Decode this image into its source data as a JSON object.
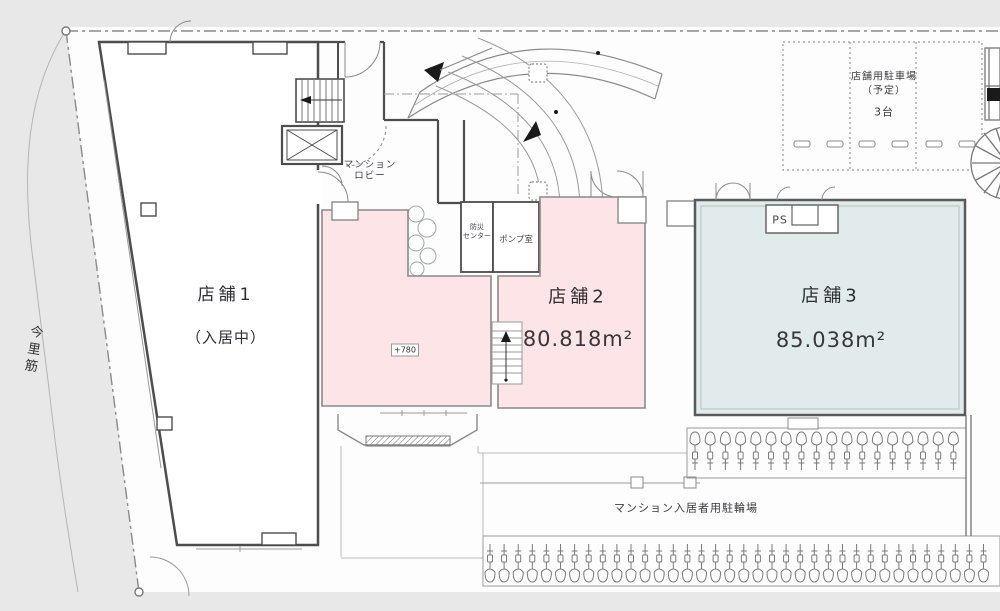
{
  "road": {
    "name": "今里筋"
  },
  "parking": {
    "title": "店舗用駐車場",
    "subtitle": "（予定）",
    "capacity": "3台"
  },
  "lobby": {
    "line1": "マンション",
    "line2": "ロビー"
  },
  "rooms": {
    "disaster_line1": "防災",
    "disaster_line2": "センター",
    "pump": "ポンプ室",
    "pipe_shaft": "PS"
  },
  "shop1": {
    "name": "店舗1",
    "status": "（入居中）"
  },
  "shop2": {
    "name": "店舗2",
    "area": "80.818m²"
  },
  "shop3": {
    "name": "店舗3",
    "area": "85.038m²"
  },
  "annotations": {
    "floor_level": "+780",
    "bicycle_parking": "マンション入居者用駐輪場"
  },
  "colors": {
    "street": "#e8e8e8",
    "wall": "#4d4d4d",
    "shop2_fill": "#fce4e7",
    "shop3_fill": "#e1ebeb"
  },
  "bicycles": {
    "upper_count": 18,
    "lower_count": 36
  }
}
